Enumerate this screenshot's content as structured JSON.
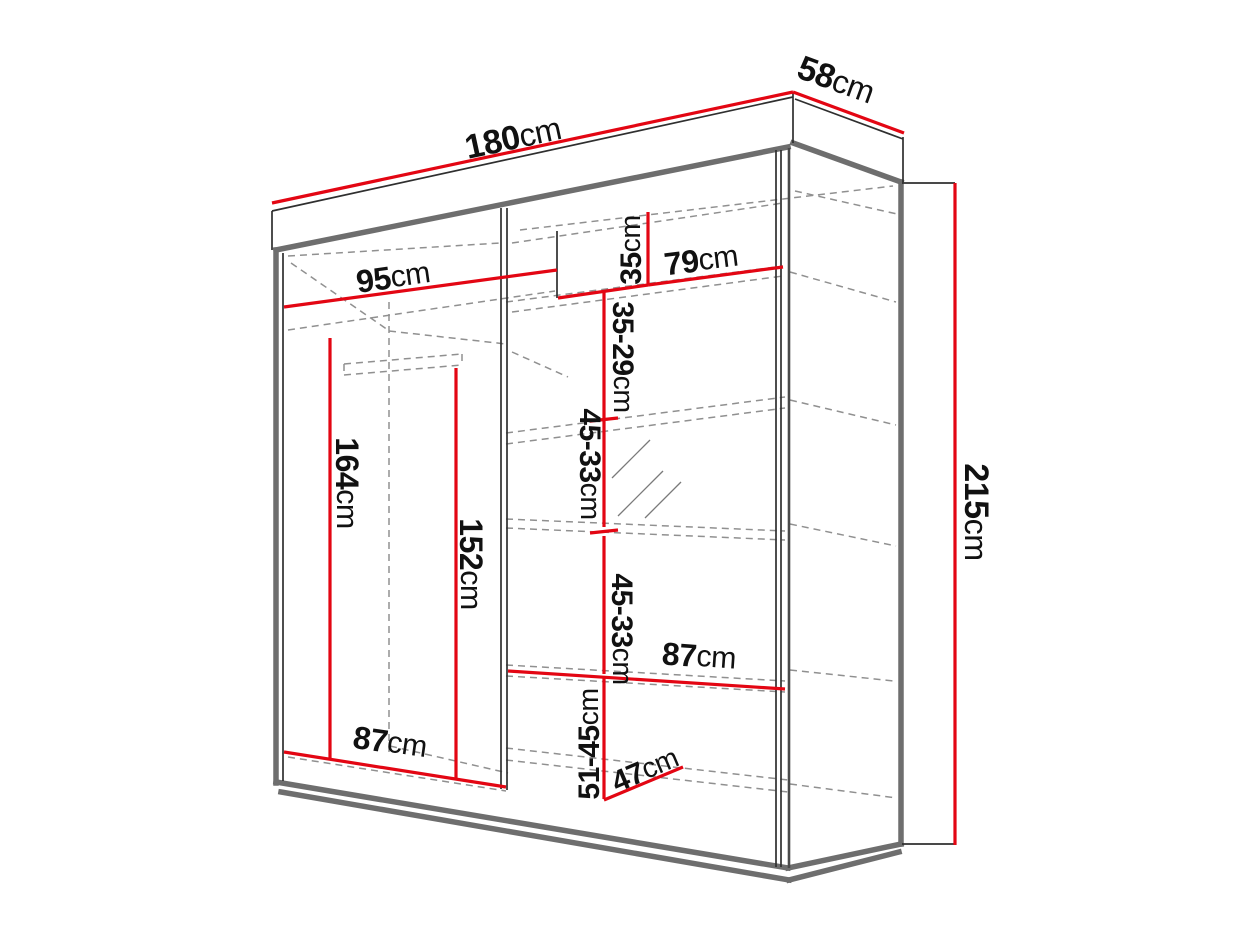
{
  "page": {
    "background": "#ffffff",
    "kind": "furniture-dimension-diagram",
    "subject": "sliding-door-wardrobe"
  },
  "canvas": {
    "width": 1243,
    "height": 932
  },
  "colors": {
    "dimension_red": "#e30613",
    "edge_dark_gray": "#6e6e6e",
    "edge_thin_black": "#2f2f2f",
    "hidden_gray": "#909090",
    "label_black": "#111111",
    "background": "#ffffff"
  },
  "cabinet": {
    "edges_thick": [
      {
        "name": "top-panel-front-bottom-edge",
        "x1": 276,
        "y1": 250,
        "x2": 788,
        "y2": 147
      },
      {
        "name": "left-outer-edge",
        "x1": 276,
        "y1": 250,
        "x2": 276,
        "y2": 783
      },
      {
        "name": "bottom-front-edge",
        "x1": 276,
        "y1": 782,
        "x2": 788,
        "y2": 868
      },
      {
        "name": "plinth-bottom-edge",
        "x1": 281,
        "y1": 792,
        "x2": 789,
        "y2": 880
      },
      {
        "name": "side-top-edge",
        "x1": 793,
        "y1": 143,
        "x2": 901,
        "y2": 182
      },
      {
        "name": "rear-right-edge",
        "x1": 901,
        "y1": 182,
        "x2": 901,
        "y2": 844
      },
      {
        "name": "side-bottom-upper-edge",
        "x1": 901,
        "y1": 844,
        "x2": 788,
        "y2": 868
      },
      {
        "name": "side-bottom-lower-edge",
        "x1": 899,
        "y1": 852,
        "x2": 789,
        "y2": 880
      }
    ],
    "edges_thin": [
      {
        "name": "top-panel-top-edge",
        "x1": 272,
        "y1": 211,
        "x2": 793,
        "y2": 97
      },
      {
        "name": "top-panel-left-edge",
        "x1": 272,
        "y1": 211,
        "x2": 272,
        "y2": 250
      },
      {
        "name": "top-panel-right-edge",
        "x1": 793,
        "y1": 92,
        "x2": 793,
        "y2": 143
      },
      {
        "name": "top-panel-rear-top-edge",
        "x1": 795,
        "y1": 99,
        "x2": 903,
        "y2": 139
      },
      {
        "name": "top-panel-rear-corner-edge",
        "x1": 903,
        "y1": 137,
        "x2": 903,
        "y2": 182
      },
      {
        "name": "height-extension-top",
        "x1": 902,
        "y1": 183,
        "x2": 955,
        "y2": 183
      },
      {
        "name": "height-extension-bottom",
        "x1": 902,
        "y1": 844,
        "x2": 955,
        "y2": 844
      },
      {
        "name": "left-inner-edge",
        "x1": 283,
        "y1": 253,
        "x2": 283,
        "y2": 781
      },
      {
        "name": "right-door-edge-a",
        "x1": 776,
        "y1": 150,
        "x2": 776,
        "y2": 867
      },
      {
        "name": "right-door-edge-b",
        "x1": 781,
        "y1": 150,
        "x2": 781,
        "y2": 867
      },
      {
        "name": "center-partition-a",
        "x1": 501,
        "y1": 208,
        "x2": 501,
        "y2": 789
      },
      {
        "name": "center-partition-b",
        "x1": 507,
        "y1": 208,
        "x2": 507,
        "y2": 790
      },
      {
        "name": "top-cubby-divider",
        "x1": 557,
        "y1": 231,
        "x2": 557,
        "y2": 298
      }
    ],
    "edges_med": [
      {
        "name": "right-front-corner-edge",
        "x1": 789,
        "y1": 148,
        "x2": 789,
        "y2": 868
      }
    ],
    "hidden_edges": [
      {
        "name": "ceiling-front-hidden",
        "x1": 288,
        "y1": 256,
        "x2": 500,
        "y2": 243
      },
      {
        "name": "left-depth-hidden",
        "x1": 291,
        "y1": 263,
        "x2": 388,
        "y2": 330
      },
      {
        "name": "left-top-shelf-hidden",
        "x1": 288,
        "y1": 330,
        "x2": 555,
        "y2": 291
      },
      {
        "name": "left-top-shelf-back-hidden",
        "x1": 389,
        "y1": 331,
        "x2": 506,
        "y2": 344
      },
      {
        "name": "hanging-rail-top",
        "x1": 344,
        "y1": 364,
        "x2": 462,
        "y2": 354
      },
      {
        "name": "hanging-rail-bottom",
        "x1": 344,
        "y1": 375,
        "x2": 462,
        "y2": 365
      },
      {
        "name": "hanging-rail-left-cap",
        "x1": 344,
        "y1": 364,
        "x2": 344,
        "y2": 375
      },
      {
        "name": "hanging-rail-right-cap",
        "x1": 462,
        "y1": 354,
        "x2": 462,
        "y2": 365
      },
      {
        "name": "rear-left-corner-hidden",
        "x1": 389,
        "y1": 302,
        "x2": 389,
        "y2": 752
      },
      {
        "name": "left-floor-hidden",
        "x1": 288,
        "y1": 757,
        "x2": 506,
        "y2": 791
      },
      {
        "name": "left-floor-back-hidden",
        "x1": 390,
        "y1": 746,
        "x2": 508,
        "y2": 773
      },
      {
        "name": "cubby-ceiling-hidden",
        "x1": 512,
        "y1": 243,
        "x2": 783,
        "y2": 203
      },
      {
        "name": "ceiling-back-hidden",
        "x1": 520,
        "y1": 230,
        "x2": 893,
        "y2": 186
      },
      {
        "name": "shelf1-front-hidden",
        "x1": 506,
        "y1": 302,
        "x2": 783,
        "y2": 266
      },
      {
        "name": "shelf1-back-hidden",
        "x1": 512,
        "y1": 312,
        "x2": 783,
        "y2": 276
      },
      {
        "name": "shelf1-side-hidden",
        "x1": 790,
        "y1": 272,
        "x2": 896,
        "y2": 302
      },
      {
        "name": "ceiling-side-hidden",
        "x1": 795,
        "y1": 191,
        "x2": 897,
        "y2": 214
      },
      {
        "name": "shelf2-front-hidden",
        "x1": 506,
        "y1": 433,
        "x2": 785,
        "y2": 397
      },
      {
        "name": "shelf2-back-hidden",
        "x1": 506,
        "y1": 444,
        "x2": 785,
        "y2": 408
      },
      {
        "name": "shelf2-side-hidden",
        "x1": 790,
        "y1": 400,
        "x2": 896,
        "y2": 425
      },
      {
        "name": "shelf2-depth-hidden",
        "x1": 512,
        "y1": 352,
        "x2": 568,
        "y2": 377
      },
      {
        "name": "shelf3-front-hidden",
        "x1": 506,
        "y1": 519,
        "x2": 785,
        "y2": 531
      },
      {
        "name": "shelf3-back-hidden",
        "x1": 506,
        "y1": 528,
        "x2": 785,
        "y2": 540
      },
      {
        "name": "shelf3-side-hidden",
        "x1": 790,
        "y1": 524,
        "x2": 896,
        "y2": 546
      },
      {
        "name": "shelf4-front-hidden",
        "x1": 506,
        "y1": 665,
        "x2": 785,
        "y2": 681
      },
      {
        "name": "shelf4-back-hidden",
        "x1": 506,
        "y1": 676,
        "x2": 785,
        "y2": 692
      },
      {
        "name": "shelf4-side-hidden",
        "x1": 790,
        "y1": 670,
        "x2": 894,
        "y2": 681
      },
      {
        "name": "floor-front-hidden",
        "x1": 506,
        "y1": 748,
        "x2": 788,
        "y2": 780
      },
      {
        "name": "floor-back-hidden",
        "x1": 506,
        "y1": 760,
        "x2": 788,
        "y2": 792
      },
      {
        "name": "floor-side-hidden",
        "x1": 790,
        "y1": 784,
        "x2": 897,
        "y2": 798
      }
    ],
    "mirror_hatches": [
      {
        "name": "mirror-hatch-1",
        "x1": 612,
        "y1": 478,
        "x2": 650,
        "y2": 440
      },
      {
        "name": "mirror-hatch-2",
        "x1": 618,
        "y1": 516,
        "x2": 663,
        "y2": 471
      },
      {
        "name": "mirror-hatch-3",
        "x1": 645,
        "y1": 518,
        "x2": 681,
        "y2": 482
      }
    ]
  },
  "dimensions": {
    "lines": [
      {
        "name": "width-total-line",
        "x1": 272,
        "y1": 203,
        "x2": 793,
        "y2": 92
      },
      {
        "name": "depth-total-line",
        "x1": 793,
        "y1": 92,
        "x2": 904,
        "y2": 133
      },
      {
        "name": "height-total-line",
        "x1": 955,
        "y1": 183,
        "x2": 955,
        "y2": 845
      },
      {
        "name": "top-left-width-line",
        "x1": 284,
        "y1": 307,
        "x2": 557,
        "y2": 270
      },
      {
        "name": "top-shelf-connector-line",
        "x1": 558,
        "y1": 298,
        "x2": 648,
        "y2": 285
      },
      {
        "name": "cubby-height-line",
        "x1": 648,
        "y1": 212,
        "x2": 648,
        "y2": 285
      },
      {
        "name": "top-right-width-line",
        "x1": 648,
        "y1": 285,
        "x2": 783,
        "y2": 267
      },
      {
        "name": "shelf-gap-1-line",
        "x1": 604,
        "y1": 292,
        "x2": 604,
        "y2": 419
      },
      {
        "name": "shelf-gap-2-line",
        "x1": 604,
        "y1": 421,
        "x2": 604,
        "y2": 527
      },
      {
        "name": "shelf-gap-3-line",
        "x1": 604,
        "y1": 536,
        "x2": 604,
        "y2": 674
      },
      {
        "name": "right-width-line",
        "x1": 508,
        "y1": 671,
        "x2": 785,
        "y2": 689
      },
      {
        "name": "shelf-gap-4-line",
        "x1": 604,
        "y1": 676,
        "x2": 604,
        "y2": 799
      },
      {
        "name": "depth-inner-line",
        "x1": 604,
        "y1": 800,
        "x2": 683,
        "y2": 767
      },
      {
        "name": "left-height-line",
        "x1": 330,
        "y1": 338,
        "x2": 330,
        "y2": 760
      },
      {
        "name": "inner-height-line",
        "x1": 456,
        "y1": 368,
        "x2": 456,
        "y2": 779
      },
      {
        "name": "left-width-line",
        "x1": 284,
        "y1": 752,
        "x2": 506,
        "y2": 787
      },
      {
        "name": "shelf-gap-tick-1",
        "x1": 590,
        "y1": 421,
        "x2": 618,
        "y2": 418
      },
      {
        "name": "shelf-gap-tick-2",
        "x1": 590,
        "y1": 533,
        "x2": 618,
        "y2": 530
      }
    ],
    "labels": [
      {
        "name": "width-total",
        "value": "180",
        "unit": "cm",
        "x": 513,
        "y": 138,
        "rot": -12.2,
        "size": 34
      },
      {
        "name": "depth-total",
        "value": "58",
        "unit": "cm",
        "x": 836,
        "y": 80,
        "rot": 20,
        "size": 34
      },
      {
        "name": "height-total",
        "value": "215",
        "unit": "cm",
        "x": 976,
        "y": 512,
        "rot": 90,
        "size": 34
      },
      {
        "name": "top-left-width",
        "value": "95",
        "unit": "cm",
        "x": 393,
        "y": 277,
        "rot": -8,
        "size": 32
      },
      {
        "name": "top-right-width",
        "value": "79",
        "unit": "cm",
        "x": 701,
        "y": 260,
        "rot": -7,
        "size": 32
      },
      {
        "name": "cubby-height",
        "value": "35",
        "unit": "cm",
        "x": 631,
        "y": 250,
        "rot": -90,
        "size": 30
      },
      {
        "name": "shelf-gap-1",
        "value": "35-29",
        "unit": "cm",
        "x": 623,
        "y": 357,
        "rot": 90,
        "size": 30
      },
      {
        "name": "shelf-gap-2",
        "value": "45-33",
        "unit": "cm",
        "x": 590,
        "y": 464,
        "rot": 90,
        "size": 30
      },
      {
        "name": "shelf-gap-3",
        "value": "45-33",
        "unit": "cm",
        "x": 622,
        "y": 629,
        "rot": 90,
        "size": 30
      },
      {
        "name": "right-width",
        "value": "87",
        "unit": "cm",
        "x": 699,
        "y": 656,
        "rot": 4,
        "size": 32
      },
      {
        "name": "shelf-gap-4",
        "value": "51-45",
        "unit": "cm",
        "x": 589,
        "y": 744,
        "rot": -90,
        "size": 30
      },
      {
        "name": "depth-inner",
        "value": "47",
        "unit": "cm",
        "x": 645,
        "y": 770,
        "rot": -23,
        "size": 30
      },
      {
        "name": "left-width",
        "value": "87",
        "unit": "cm",
        "x": 390,
        "y": 742,
        "rot": 8,
        "size": 32
      },
      {
        "name": "left-height",
        "value": "164",
        "unit": "cm",
        "x": 347,
        "y": 483,
        "rot": 90,
        "size": 32
      },
      {
        "name": "inner-height",
        "value": "152",
        "unit": "cm",
        "x": 471,
        "y": 564,
        "rot": 90,
        "size": 32
      }
    ]
  }
}
